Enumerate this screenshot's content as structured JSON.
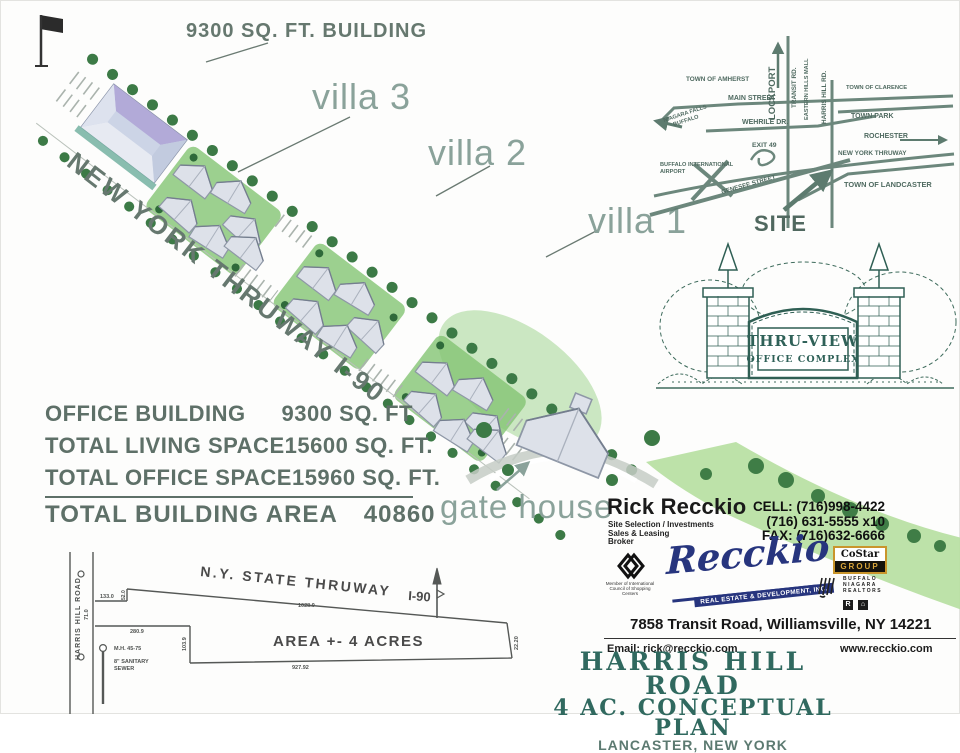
{
  "colors": {
    "label_green": "#8aa29a",
    "dark_label_green": "#66786f",
    "title_teal": "#30695f",
    "map_ink": "#4f6a60",
    "survey_ink": "#4f5250",
    "recckio_navy": "#27357e",
    "costar_gold": "#c9952c",
    "tree_green": "#3c7a46",
    "lawn_green": "#83c473"
  },
  "plan": {
    "building_label": "9300 SQ. FT. BUILDING",
    "villa_3": "villa 3",
    "villa_2": "villa 2",
    "villa_1": "villa 1",
    "thruway_label": "NEW YORK THRUWAY I-90",
    "gate_house_label": "gate house"
  },
  "inset_map": {
    "lockport": "LOCKPORT",
    "transit_rd": "TRANSIT RD.",
    "eastern_hills": "EASTERN HILLS MALL",
    "harris_hill_rd": "HARRIS HILL RD.",
    "town_of_amherst": "TOWN OF AMHERST",
    "town_of_clarence": "TOWN OF CLARENCE",
    "main_street": "MAIN STREET",
    "town_park": "TOWN PARK",
    "niagara_falls": "NIAGARA FALLS",
    "buffalo": "BUFFALO",
    "wehrile_dr": "WEHRILE DR.",
    "rochester": "ROCHESTER",
    "exit_49": "EXIT 49",
    "new_york_thruway": "NEW YORK THRUWAY",
    "buffalo_international": "BUFFALO INTERNATIONAL",
    "airport": "AIRPORT",
    "genesee_street": "GENESEE STREET",
    "town_of_lancaster": "TOWN OF LANDCASTER",
    "site": "SITE"
  },
  "sign": {
    "name": "THRU-VIEW",
    "subtitle": "OFFICE COMPLEX"
  },
  "area_table": {
    "rows": [
      {
        "label": "OFFICE BUILDING",
        "value": "9300 SQ. FT"
      },
      {
        "label": "TOTAL LIVING SPACE",
        "value": "15600 SQ. FT."
      },
      {
        "label": "TOTAL OFFICE SPACE",
        "value": "15960 SQ. FT."
      }
    ],
    "total_label": "TOTAL BUILDING AREA",
    "total_value": "40860"
  },
  "broker": {
    "name": "Rick Recckio",
    "role_lines": [
      "Site Selection / Investments",
      "Sales & Leasing",
      "Broker"
    ],
    "phones": [
      "CELL: (716)998-4422",
      "(716) 631-5555 x10",
      "FAX: (716)632-6666"
    ],
    "icsc_caption": "Member of International Council of Shopping Centers",
    "logo_text": "Recckio",
    "logo_subtext": "REAL ESTATE & DEVELOPMENT, INC.",
    "costar_top": "CoStar",
    "costar_bottom": "GROUP",
    "realtors_lines": [
      "BUFFALO",
      "NIAGARA",
      "REALTORS"
    ],
    "realtor_badge": "R",
    "housing_badge": "⌂",
    "address": "7858 Transit Road, Williamsville, NY  14221",
    "email": "Email: rick@recckio.com",
    "website": "www.recckio.com"
  },
  "title_block": {
    "line1": "HARRIS HILL ROAD",
    "line2": "4 AC. CONCEPTUAL PLAN",
    "line3": "LANCASTER, NEW YORK"
  },
  "survey": {
    "road_label": "HARRIS HILL ROAD",
    "thruway_label": "N.Y. STATE THRUWAY",
    "i90": "I-90",
    "area_label": "AREA +- 4 ACRES",
    "dim_top": "1028.9",
    "dim_bottom": "927.92",
    "dim_133": "133.0",
    "dim_52": "52.0",
    "dim_71": "71.0",
    "dim_280": "280.9",
    "dim_103": "103.9",
    "dim_2220": "22.20",
    "manhole_label": "M.H. 45-75",
    "sewer_label_1": "8\" SANITARY",
    "sewer_label_2": "SEWER"
  }
}
